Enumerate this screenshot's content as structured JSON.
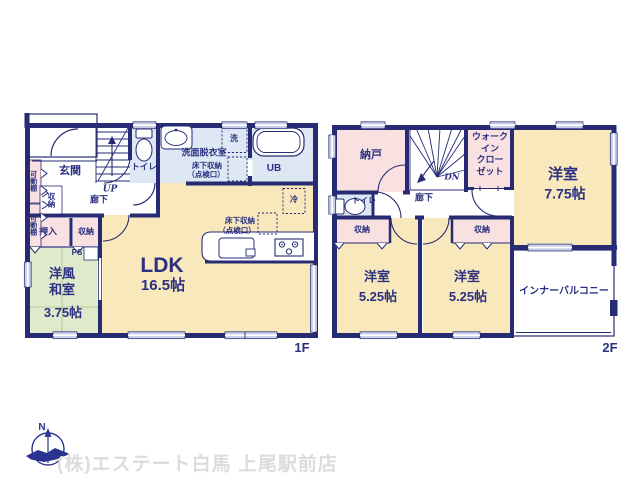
{
  "floor1": {
    "floor_label": "1F",
    "rooms": {
      "genkan": "玄関",
      "kadoudana": "可動棚",
      "shunou": "収納",
      "oshiire": "押入",
      "rouka": "廊下",
      "up": "UP",
      "toilet": "トイレ",
      "senmen_datsuiji": "洗面脱衣室",
      "underfloor_l1": "床下収納",
      "underfloor_l2": "（点検口）",
      "washer": "洗",
      "ub": "UB",
      "fridge": "冷",
      "ldk": "LDK",
      "ldk_size": "16.5帖",
      "ps": "PS",
      "washitsu_l1": "洋風",
      "washitsu_l2": "和室",
      "washitsu_size": "3.75帖"
    }
  },
  "floor2": {
    "floor_label": "2F",
    "rooms": {
      "nando": "納戸",
      "dn": "DN",
      "wic_l1": "ウォーク",
      "wic_l2": "イン",
      "wic_l3": "クロー",
      "wic_l4": "ゼット",
      "yoshitsu_main": "洋室",
      "yoshitsu_main_size": "7.75帖",
      "toilet": "トイレ",
      "rouka": "廊下",
      "shunou": "収納",
      "yoshitsu_sub": "洋室",
      "yoshitsu_sub_size": "5.25帖",
      "balcony": "インナーバルコニー"
    }
  },
  "footer": {
    "north_label": "N",
    "company": "(株)エステート白馬 上尾駅前店"
  },
  "colors": {
    "wall": "#262b74",
    "text": "#2b3080",
    "room_cream": "#f8e8bc",
    "room_pink": "#f9e1e1",
    "room_blue": "#dde8f4",
    "room_green": "#dfe9cb",
    "tatami_line": "#b7c79e",
    "window_fill": "#c7cbe6",
    "company_text": "#dcdcd9",
    "compass": "#2a3390"
  }
}
